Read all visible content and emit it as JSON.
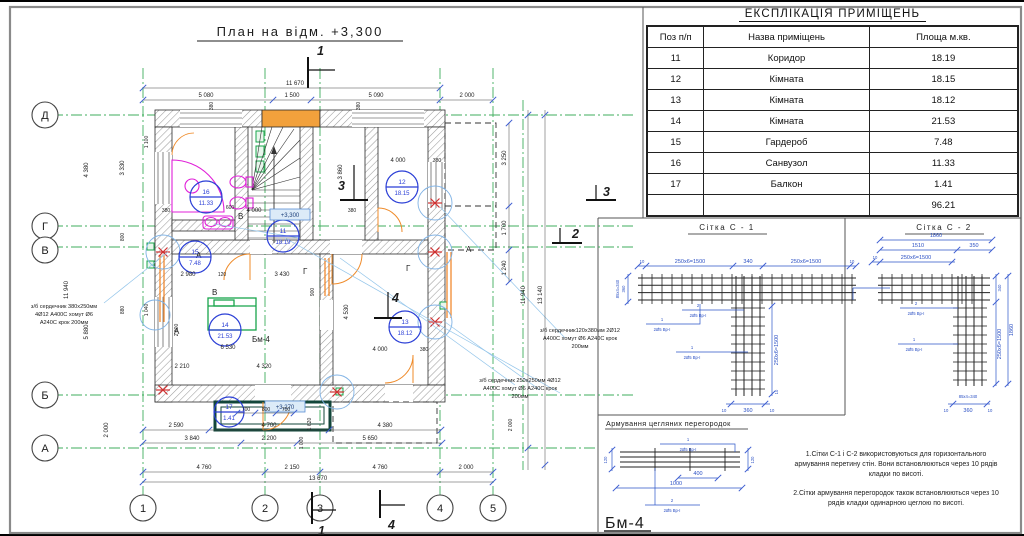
{
  "plan": {
    "title": "План на відм. +3,300",
    "axes_rows": [
      "Д",
      "Г",
      "В",
      "Б",
      "А"
    ],
    "axes_cols": [
      "1",
      "2",
      "3",
      "4",
      "5"
    ],
    "marks": {
      "m1": "1",
      "m2": "2",
      "m3": "3",
      "m4": "4"
    },
    "levels": {
      "main": "+3,300",
      "balcony": "+3,270"
    },
    "bm4_ref": "Бм-4",
    "letters": {
      "a": "А",
      "b": "В",
      "g": "Г"
    },
    "rooms": [
      {
        "num": "16",
        "area": "11.33"
      },
      {
        "num": "11",
        "area": "18.19"
      },
      {
        "num": "12",
        "area": "18.15"
      },
      {
        "num": "15",
        "area": "7.48"
      },
      {
        "num": "14",
        "area": "21.53"
      },
      {
        "num": "13",
        "area": "18.12"
      },
      {
        "num": "17",
        "area": "1.41"
      }
    ],
    "ann_left": [
      "з/б сердечник 380х250мм",
      "4Ø12 А400С хомут Ø6",
      "А240С крок 200мм"
    ],
    "ann_r1": [
      "з/б сердечник120х380мм 2Ø12",
      "А400С хомут Ø6 А240С крок",
      "200мм"
    ],
    "ann_r2": [
      "з/б сердечник 250х250мм 4Ø12",
      "А400С хомут Ø6 А240С крок",
      "200мм"
    ],
    "dims": {
      "d11670": "11 670",
      "d5080": "5 080",
      "d1500": "1 500",
      "d5090": "5 090",
      "d2000": "2 000",
      "d380": "380",
      "d13670": "13 670",
      "d4760": "4 760",
      "d2150": "2 150",
      "d2590": "2 590",
      "d4700": "4 700",
      "d4380": "4 380",
      "d3840": "3 840",
      "d2200": "2 200",
      "d5650": "5 650",
      "d700": "700",
      "d800": "800",
      "d600": "600",
      "d900": "900",
      "d1620": "1 620",
      "d1000": "1 000",
      "d4000": "4 000",
      "d2980": "2 980",
      "d120": "120",
      "d3430": "3 430",
      "d6530": "6 530",
      "d2210": "2 210",
      "d4320": "4 320",
      "d4530": "4 530",
      "d3860": "3 860",
      "d3330": "3 330",
      "d5880": "5 880",
      "d880": "880",
      "d1040": "1 040",
      "d1100": "1 100",
      "d11940": "11 940",
      "d3250": "3 250",
      "d1700": "1 700",
      "d1240": "1 240",
      "d13140": "13 140",
      "d2900": "2 900"
    }
  },
  "table": {
    "title": "ЕКСПЛІКАЦІЯ ПРИМІЩЕНЬ",
    "headers": [
      "Поз п/п",
      "Назва приміщень",
      "Площа м.кв."
    ],
    "rows": [
      [
        "11",
        "Коридор",
        "18.19"
      ],
      [
        "12",
        "Кімната",
        "18.15"
      ],
      [
        "13",
        "Кімната",
        "18.12"
      ],
      [
        "14",
        "Кімната",
        "21.53"
      ],
      [
        "15",
        "Гардероб",
        "7.48"
      ],
      [
        "16",
        "Санвузол",
        "11.33"
      ],
      [
        "17",
        "Балкон",
        "1.41"
      ],
      [
        "",
        "",
        "96.21"
      ]
    ]
  },
  "details": {
    "s1_title": "Сітка  С - 1",
    "s2_title": "Сітка  С - 2",
    "brick_title": "Армування цегляних перегородок",
    "bm4_title": "Бм-4",
    "bar": "2Ø5 Вр-І",
    "pos1": "1",
    "pos2": "2",
    "dims": {
      "d10": "10",
      "d250": "250х6=1500",
      "d340": "340",
      "d360": "360",
      "d85": "85х4=340",
      "d1860": "1860",
      "d1510": "1510",
      "d350": "350",
      "d120": "120",
      "d400": "400",
      "d1000": "1000"
    },
    "note1": "1.Сітки С-1 і С-2 використовуються для горизонтального армування перетину стін. Вони встановлюються через 10 рядів кладки по висоті.",
    "note2": "2.Сітки армування перегородок також встановлюються через 10 рядів кладки одинарною цеглою по висоті."
  }
}
